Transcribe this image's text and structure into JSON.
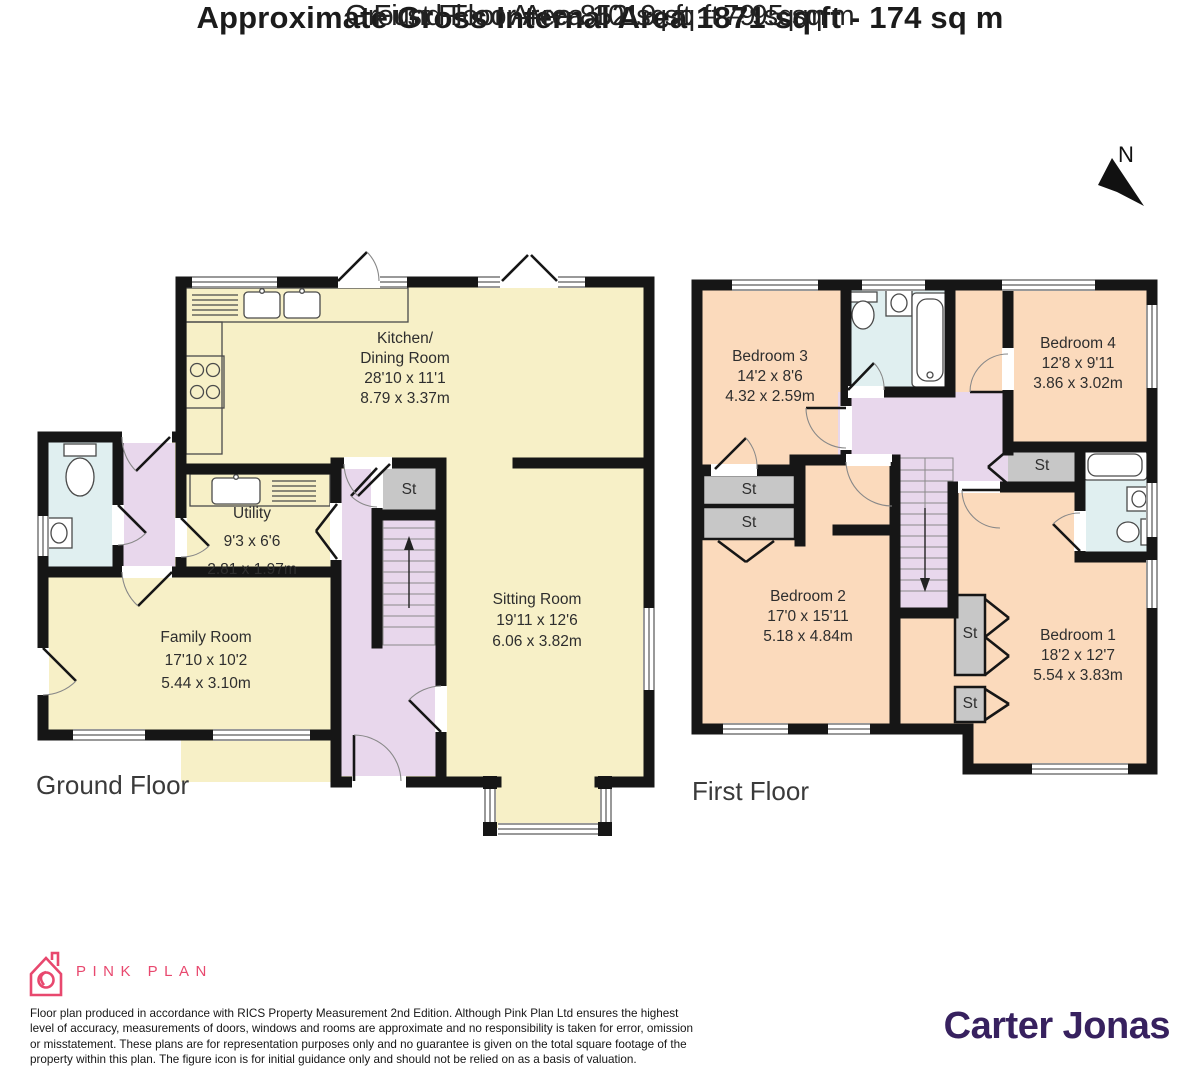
{
  "header": {
    "title": "Approximate Gross Internal Area 1871 sq ft - 174 sq m",
    "ground_area": "Ground Floor Area 1019 sq ft – 95 sq m",
    "first_area": "First Floor Area 852 sq ft – 79 sq m"
  },
  "compass": {
    "label": "N"
  },
  "floor_labels": {
    "ground": "Ground Floor",
    "first": "First Floor"
  },
  "rooms": [
    {
      "id": "kitchen-dining",
      "floor": "ground",
      "cx": 405,
      "top": 329,
      "lh": 20,
      "lines": [
        "Kitchen/",
        "Dining Room",
        "28'10 x 11'1",
        "8.79 x 3.37m"
      ]
    },
    {
      "id": "utility",
      "floor": "ground",
      "cx": 252,
      "top": 500,
      "lh": 28,
      "lines": [
        "Utility",
        "9'3 x 6'6",
        "2.81 x 1.97m"
      ]
    },
    {
      "id": "family-room",
      "floor": "ground",
      "cx": 206,
      "top": 626,
      "lh": 23,
      "lines": [
        "Family Room",
        "17'10 x 10'2",
        "5.44 x 3.10m"
      ]
    },
    {
      "id": "sitting-room",
      "floor": "ground",
      "cx": 537,
      "top": 589,
      "lh": 21,
      "lines": [
        "Sitting Room",
        "19'11 x 12'6",
        "6.06 x 3.82m"
      ]
    },
    {
      "id": "bedroom-3",
      "floor": "first",
      "cx": 770,
      "top": 347,
      "lh": 20,
      "lines": [
        "Bedroom 3",
        "14'2 x 8'6",
        "4.32 x 2.59m"
      ]
    },
    {
      "id": "bedroom-4",
      "floor": "first",
      "cx": 1078,
      "top": 334,
      "lh": 20,
      "lines": [
        "Bedroom 4",
        "12'8 x 9'11",
        "3.86 x 3.02m"
      ]
    },
    {
      "id": "bedroom-2",
      "floor": "first",
      "cx": 808,
      "top": 587,
      "lh": 20,
      "lines": [
        "Bedroom 2",
        "17'0 x 15'11",
        "5.18 x 4.84m"
      ]
    },
    {
      "id": "bedroom-1",
      "floor": "first",
      "cx": 1078,
      "top": 626,
      "lh": 20,
      "lines": [
        "Bedroom 1",
        "18'2 x 12'7",
        "5.54 x 3.83m"
      ]
    }
  ],
  "storage_labels": [
    {
      "id": "st-ground",
      "cx": 409,
      "cy": 490,
      "text": "St"
    },
    {
      "id": "st-first-left-1",
      "cx": 749,
      "cy": 490,
      "text": "St"
    },
    {
      "id": "st-first-left-2",
      "cx": 749,
      "cy": 523,
      "text": "St"
    },
    {
      "id": "st-first-middle",
      "cx": 1042,
      "cy": 466,
      "text": "St"
    },
    {
      "id": "st-first-low-1",
      "cx": 970,
      "cy": 634,
      "text": "St"
    },
    {
      "id": "st-first-low-2",
      "cx": 970,
      "cy": 704,
      "text": "St"
    }
  ],
  "footer": {
    "brand": "PINK PLAN",
    "disclaimer_lines": [
      "Floor plan produced in accordance with RICS Property Measurement 2nd Edition. Although Pink Plan Ltd ensures the highest",
      "level of accuracy, measurements of doors, windows and rooms are approximate and no responsibility is taken for error, omission",
      "or misstatement. These plans are for representation purposes only and no guarantee is given on the total square footage of the",
      "property within this plan. The figure icon is for initial guidance only and should not be relied on as a basis of valuation."
    ],
    "agent": "Carter Jonas"
  },
  "colors": {
    "ground_room_fill": "#F7F0C7",
    "first_room_fill": "#FBDABC",
    "hall_fill": "#E8D7EC",
    "bathroom_fill": "#E0EFF0",
    "storage_fill": "#C7C7C7",
    "wall": "#161616",
    "brand_pink": "#E8486E",
    "agent_purple": "#37215F"
  }
}
